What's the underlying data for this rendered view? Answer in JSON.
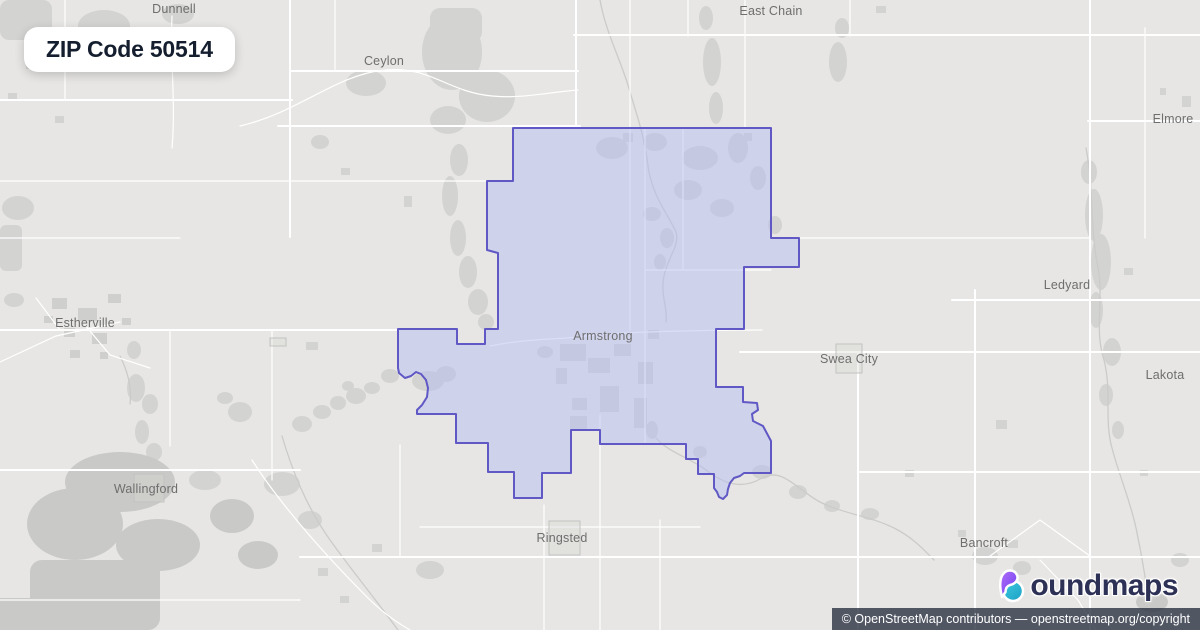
{
  "badge": {
    "title": "ZIP Code 50514"
  },
  "map": {
    "towns": [
      {
        "name": "Dunnell"
      },
      {
        "name": "Ceylon"
      },
      {
        "name": "East Chain"
      },
      {
        "name": "Elmore"
      },
      {
        "name": "Estherville"
      },
      {
        "name": "Ledyard"
      },
      {
        "name": "Swea City"
      },
      {
        "name": "Armstrong"
      },
      {
        "name": "Lakota"
      },
      {
        "name": "Wallingford"
      },
      {
        "name": "Ringsted"
      },
      {
        "name": "Bancroft"
      }
    ],
    "colors": {
      "background": "#e7e6e4",
      "patch": "#d3d3d1",
      "road": "#ffffff",
      "label": "#6e6e6e",
      "highlight_fill": "#b7bdf2",
      "highlight_border": "#6058c4"
    },
    "zip_boundary": {
      "fill_opacity": 0.5,
      "stroke_width": 2,
      "points": [
        [
          513,
          128
        ],
        [
          771,
          128
        ],
        [
          771,
          238
        ],
        [
          799,
          238
        ],
        [
          799,
          267
        ],
        [
          744,
          267
        ],
        [
          744,
          329
        ],
        [
          716,
          329
        ],
        [
          716,
          387
        ],
        [
          743,
          387
        ],
        [
          743,
          402
        ],
        [
          757,
          403
        ],
        [
          758,
          410
        ],
        [
          752,
          414
        ],
        [
          753,
          421
        ],
        [
          763,
          426
        ],
        [
          771,
          441
        ],
        [
          771,
          473
        ],
        [
          744,
          473
        ],
        [
          740,
          476
        ],
        [
          734,
          478
        ],
        [
          730,
          483
        ],
        [
          728,
          489
        ],
        [
          727,
          495
        ],
        [
          723,
          499
        ],
        [
          719,
          497
        ],
        [
          717,
          492
        ],
        [
          714,
          488
        ],
        [
          714,
          474
        ],
        [
          698,
          474
        ],
        [
          698,
          459
        ],
        [
          686,
          459
        ],
        [
          686,
          444
        ],
        [
          600,
          444
        ],
        [
          600,
          430
        ],
        [
          571,
          430
        ],
        [
          571,
          473
        ],
        [
          542,
          473
        ],
        [
          542,
          498
        ],
        [
          514,
          498
        ],
        [
          514,
          472
        ],
        [
          488,
          472
        ],
        [
          488,
          443
        ],
        [
          456,
          443
        ],
        [
          456,
          414
        ],
        [
          417,
          414
        ],
        [
          417,
          410
        ],
        [
          422,
          405
        ],
        [
          427,
          397
        ],
        [
          428,
          388
        ],
        [
          426,
          380
        ],
        [
          421,
          374
        ],
        [
          416,
          372
        ],
        [
          411,
          376
        ],
        [
          405,
          378
        ],
        [
          399,
          373
        ],
        [
          398,
          368
        ],
        [
          398,
          329
        ],
        [
          457,
          329
        ],
        [
          457,
          344
        ],
        [
          485,
          344
        ],
        [
          485,
          329
        ],
        [
          498,
          329
        ],
        [
          498,
          253
        ],
        [
          487,
          250
        ],
        [
          487,
          181
        ],
        [
          513,
          181
        ]
      ]
    }
  },
  "logo": {
    "wordmark": "boundmaps",
    "wordmark_rest": "oundmaps",
    "colors": {
      "text": "#2e3156",
      "purple": "#8b5cf6",
      "teal": "#22b8cf"
    }
  },
  "attribution": {
    "text": "© OpenStreetMap contributors — openstreetmap.org/copyright"
  }
}
